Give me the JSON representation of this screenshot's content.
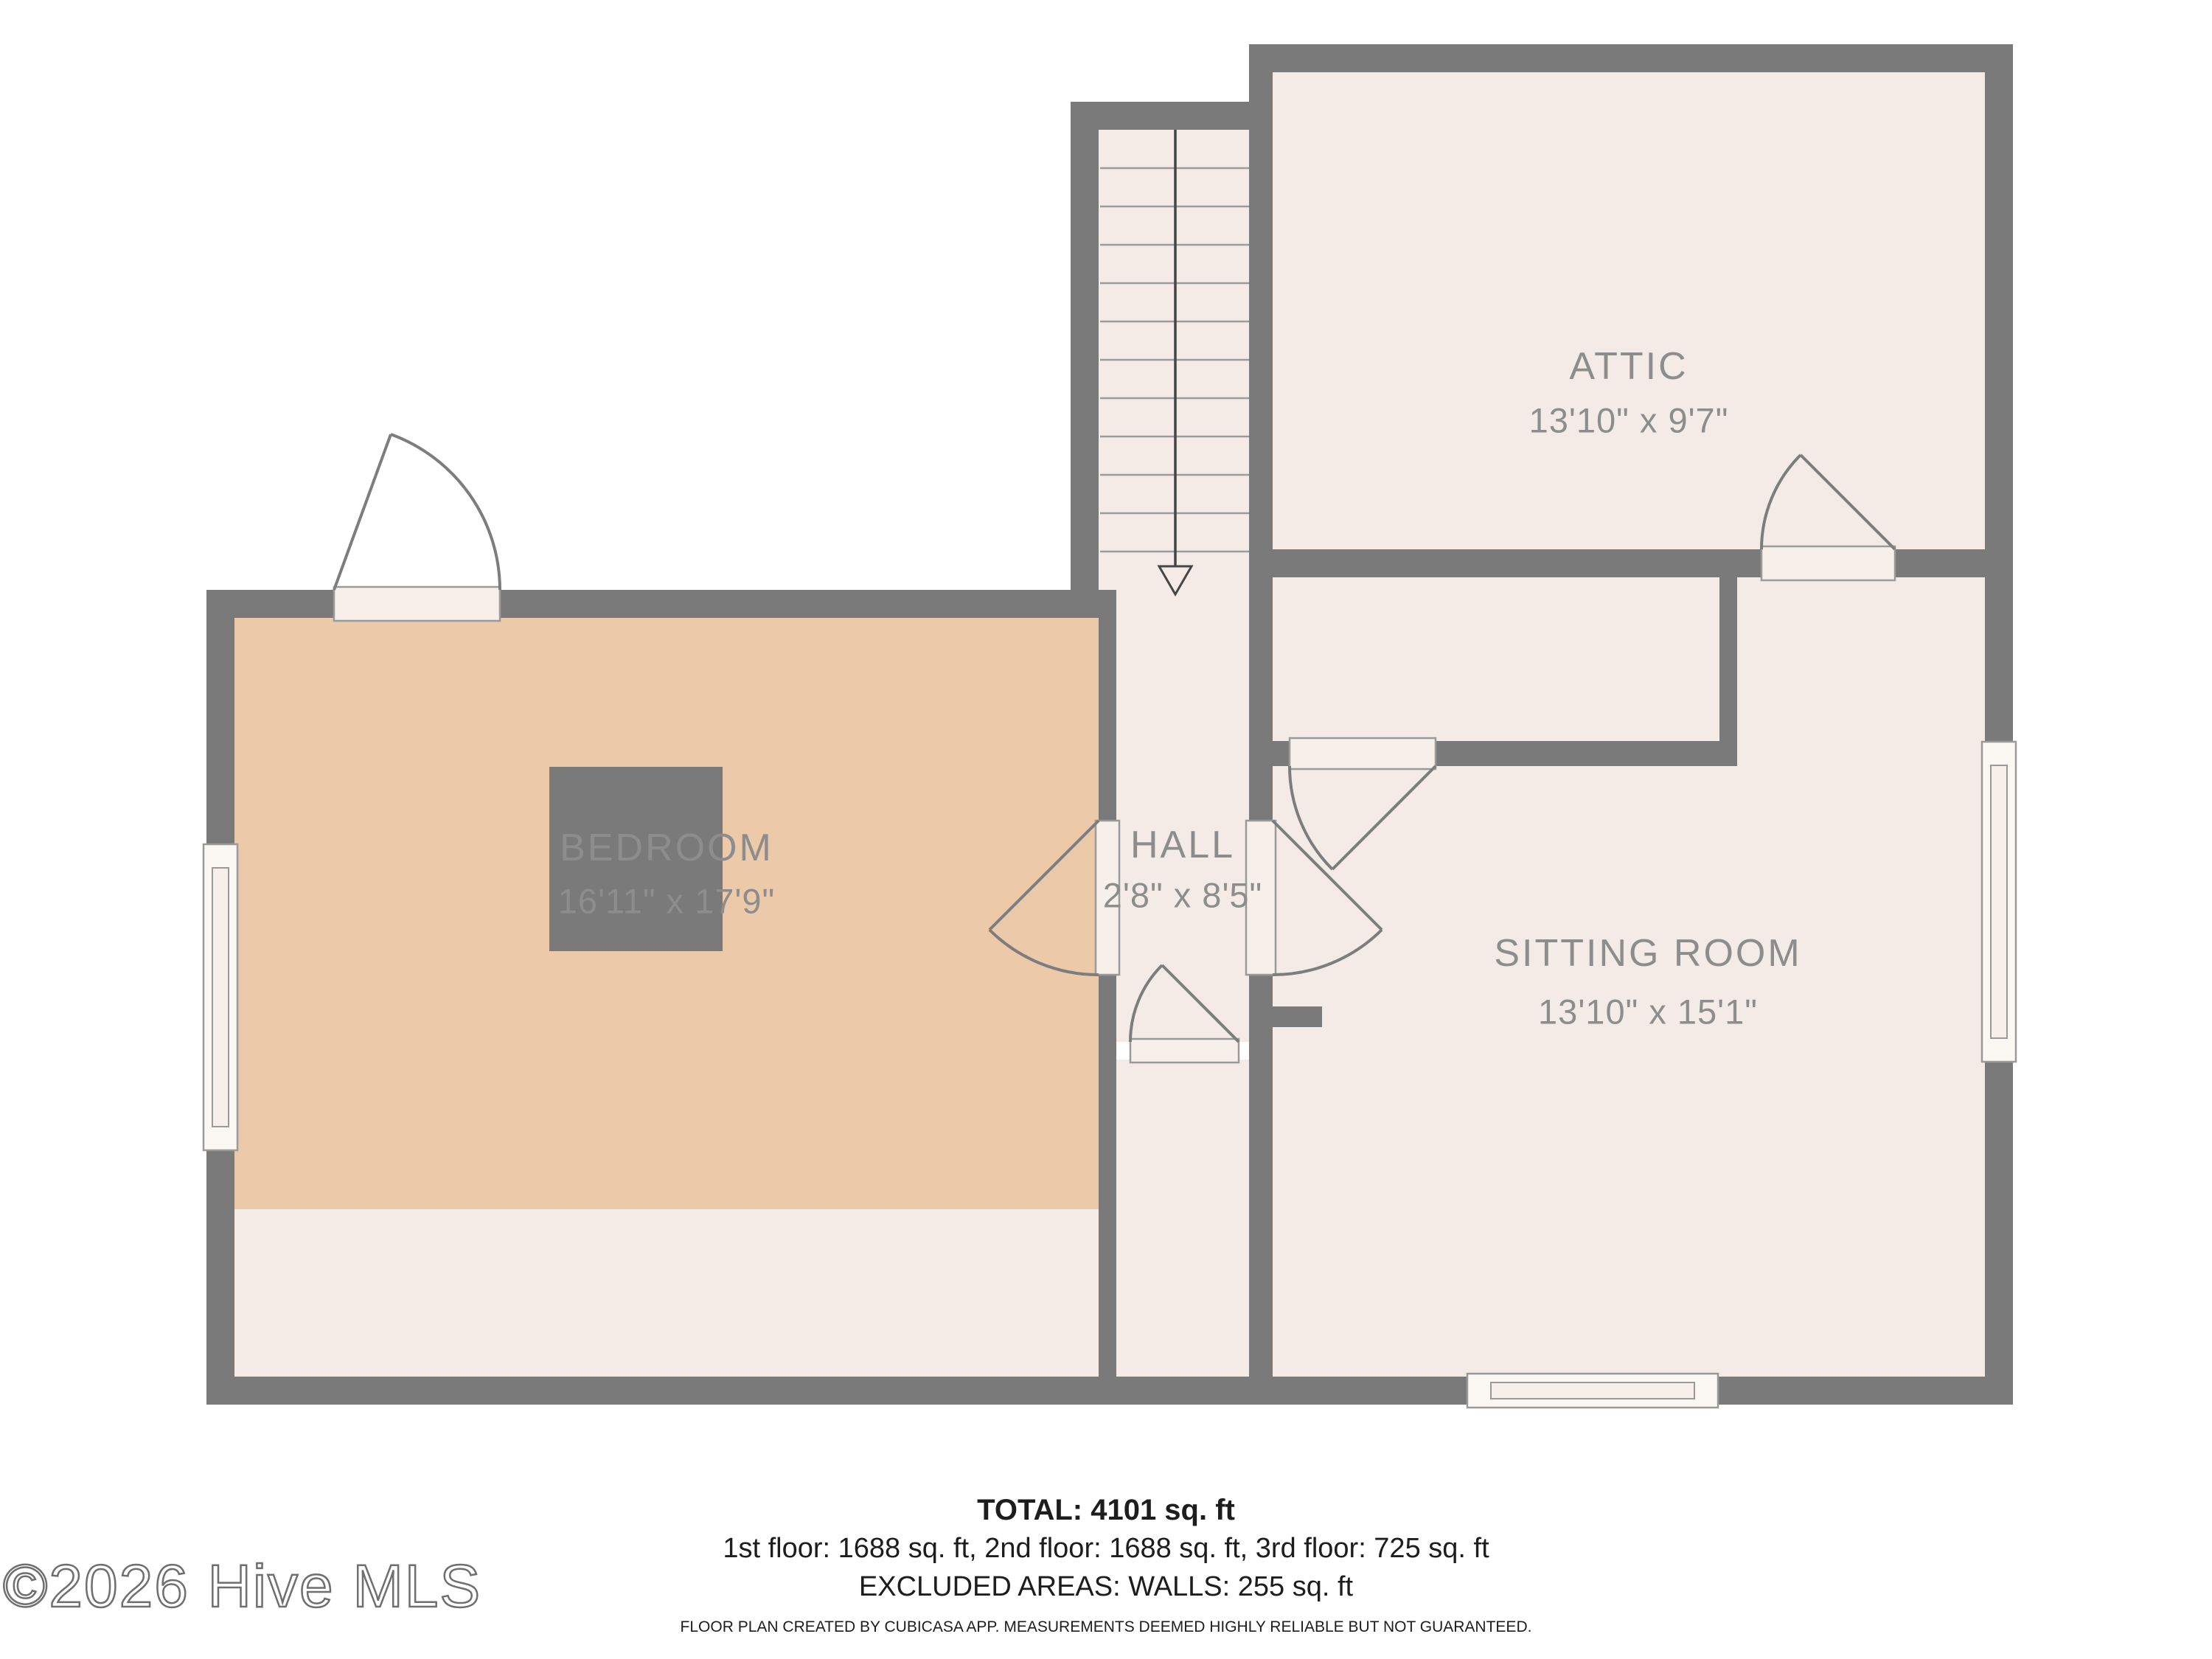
{
  "colors": {
    "wall": "#7a7a7a",
    "room": "#f4ebe6",
    "bedroom": "#ecc9a8",
    "label": "#8d8d8d",
    "ink": "#1d1d1d"
  },
  "rooms": {
    "bedroom": {
      "label": "BEDROOM",
      "dims": "16'11\" x 17'9\""
    },
    "hall": {
      "label": "HALL",
      "dims": "2'8\" x 8'5\""
    },
    "attic": {
      "label": "ATTIC",
      "dims": "13'10\" x 9'7\""
    },
    "sitting_room": {
      "label": "SITTING ROOM",
      "dims": "13'10\" x 15'1\""
    }
  },
  "summary": {
    "total": "TOTAL: 4101 sq. ft",
    "floors": "1st floor: 1688 sq. ft, 2nd floor: 1688 sq. ft, 3rd floor: 725 sq. ft",
    "excluded": "EXCLUDED AREAS: WALLS: 255 sq. ft",
    "disclaimer": "FLOOR PLAN CREATED BY CUBICASA APP. MEASUREMENTS DEEMED HIGHLY RELIABLE BUT NOT GUARANTEED."
  },
  "watermark": "©2026 Hive MLS"
}
